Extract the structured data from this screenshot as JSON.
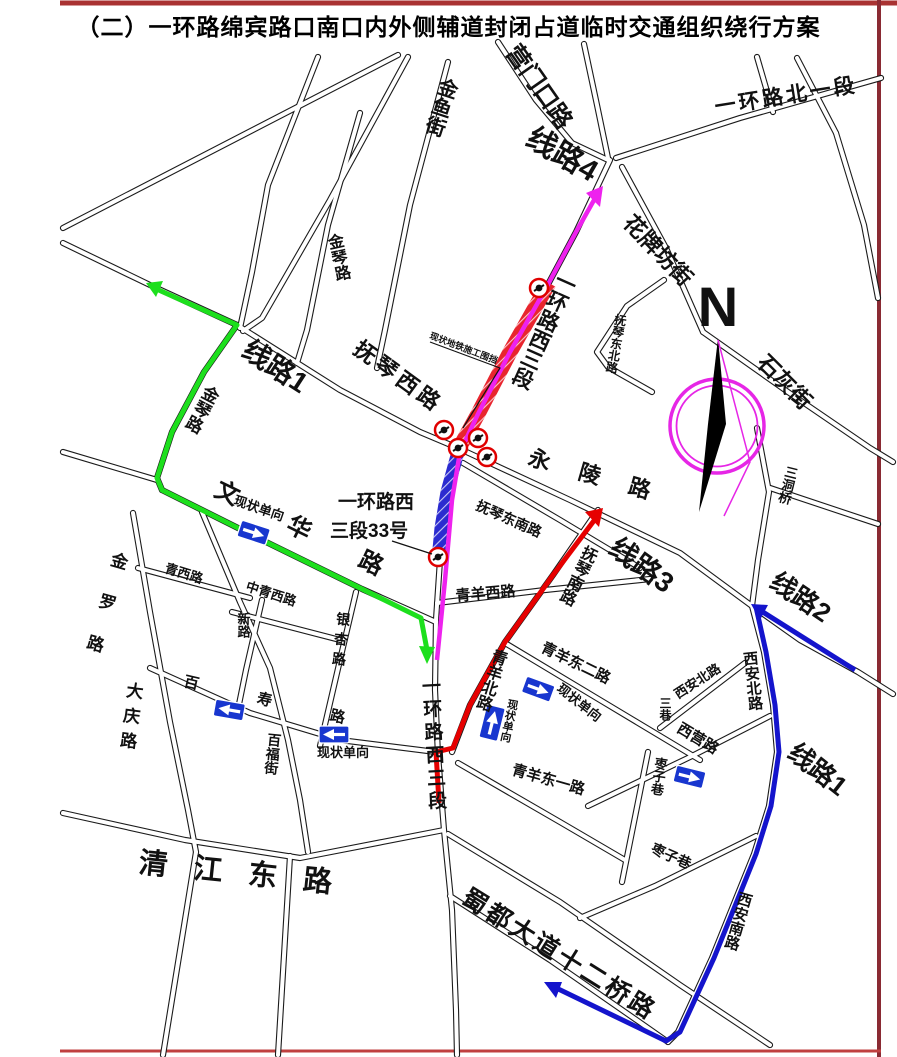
{
  "title": "（二）一环路绵宾路口南口内外侧辅道封闭占道临时交通组织绕行方案",
  "compass": {
    "north_label": "N"
  },
  "colors": {
    "route_1_green": "#1ddf1d",
    "route_2_blue": "#1414cc",
    "route_3_red": "#e60000",
    "route_4_magenta": "#ee22ee",
    "construction_band_red": "#e8252e",
    "closed_lane_band_blue": "#2b2bd0",
    "one_way_sign_blue": "#1836cf",
    "closure_marker_red": "#e00000",
    "border_red": "#a93232"
  },
  "icons": {
    "one_way_sign": "blue-rect-white-arrow",
    "closure_marker": "red-circle-black-camera",
    "compass": "magenta-circle-black-needle"
  },
  "routes": [
    {
      "name": "线路1",
      "color_key": "route_1_green"
    },
    {
      "name": "线路2",
      "color_key": "route_2_blue"
    },
    {
      "name": "线路3",
      "color_key": "route_3_red"
    },
    {
      "name": "线路4",
      "color_key": "route_4_magenta"
    },
    {
      "name": "线路1",
      "color_key": "route_2_blue"
    }
  ],
  "labels": {
    "xianlu1": "线路1",
    "xianlu2": "线路2",
    "xianlu3": "线路3",
    "xianlu4": "线路4",
    "yihuanlu_xisanduan": "一环路西三段",
    "yihuanlu_beiyiduan": "一环路北一段",
    "yingmenkou_lu": "营门口路",
    "jinyu_jie": "金鱼街",
    "jinqin_lu": "金琴路",
    "huapaifang_jie": "花牌坊街",
    "shihui_jie": "石灰街",
    "sandongqiao": "三洞桥",
    "fuqin_xi_lu": "抚琴西路",
    "fuqin_dongbei_lu": "抚琴东北路",
    "fuqin_dongnan_lu": "抚琴东南路",
    "fuqin_nan_lu": "抚琴南路",
    "yongling_lu": "永陵路",
    "qingyang_xi_lu": "青羊西路",
    "qingyang_bei_lu": "青羊北路",
    "qingyang_dong_er_lu": "青羊东二路",
    "qingyang_dong_yi_lu": "青羊东一路",
    "xian_bei_lu": "西安北路",
    "sanxiang": "三巷",
    "xiying_lu": "西营路",
    "zaozi_xiang": "枣子巷",
    "xian_nan_lu": "西安南路",
    "shudu_dadao_12qiao_lu": "蜀都大道十二桥路",
    "qingjiang_dong_lu": "清江东路",
    "daqing_lu": "大庆路",
    "jinluo_lu": "金罗路",
    "qingxi_lu": "青西路",
    "zhongqingxi_lu": "中青西路",
    "xin_lu": "新路",
    "yinxing_lu": "银杏路",
    "baishou_lu": "百寿路",
    "baifu_jie": "百福街",
    "wenhua_lu": "文华路",
    "address_line1": "一环路西",
    "address_line2": "三段33号",
    "construction_note": "现状地铁施工围挡",
    "one_way_note": "现状单向",
    "north": "N"
  }
}
